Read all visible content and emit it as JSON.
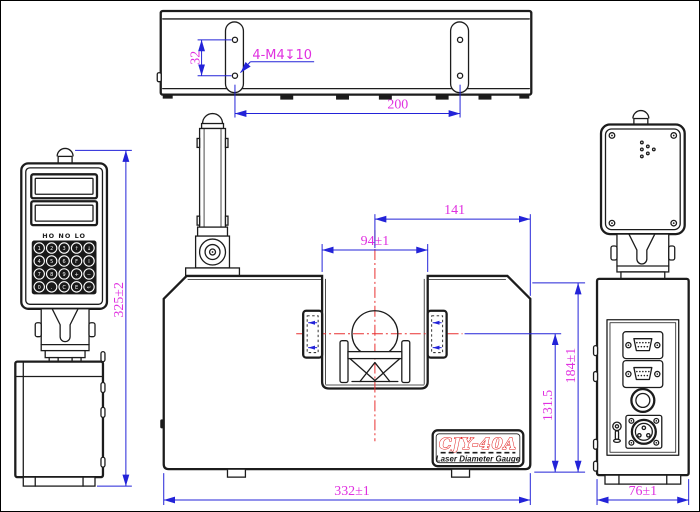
{
  "drawing": {
    "title": "CJY-40A Laser Diameter Gauge engineering drawing",
    "nameplate": {
      "model": "CJY-40A",
      "subtitle": "Laser Diameter Gauge"
    },
    "panel": {
      "indicators": "HO NO LO",
      "keypad": [
        [
          "1",
          "2",
          "3",
          "↑",
          "↓"
        ],
        [
          "4",
          "5",
          "6",
          "F",
          "I"
        ],
        [
          "7",
          "8",
          "9",
          "+",
          "−"
        ],
        [
          "0",
          ".",
          "C",
          "E",
          "↵"
        ]
      ]
    },
    "dims": {
      "top_hole_pitch_y": "32",
      "top_thread_callout": "4-M4↧10",
      "top_hole_pitch_x": "200",
      "left_overall_height": "325±2",
      "front_center_to_edge": "141",
      "front_gap_width": "94±1",
      "front_body_height": "184±1",
      "front_center_height": "131.5",
      "front_overall_width": "332±1",
      "right_overall_depth": "76±1"
    }
  },
  "colors": {
    "outline": "#1c1c1c",
    "dim": "#2323d8",
    "dimtext": "#e030e0",
    "centerline": "#e83030",
    "brandred": "#e01818",
    "bg": "#ffffff"
  }
}
